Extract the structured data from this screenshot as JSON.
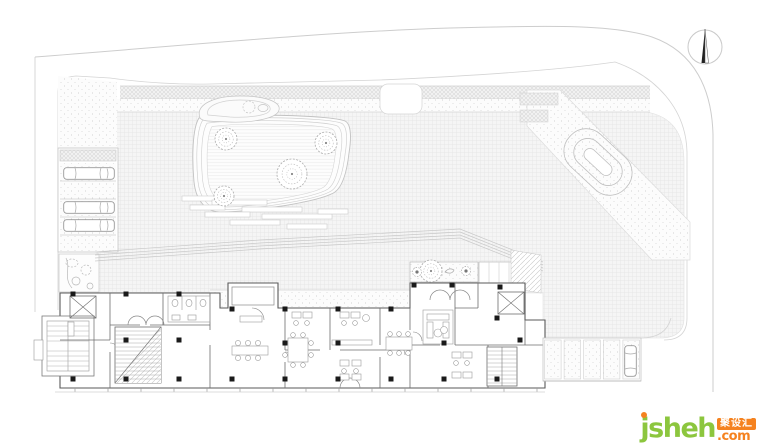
{
  "page": {
    "background": "#ffffff"
  },
  "logo": {
    "brand": "jsheh",
    "cjk": "聚设汇",
    "tld": ".com",
    "green": "#8cc63e",
    "orange": "#f5821f"
  },
  "plan": {
    "trees": [
      {
        "cx": 226,
        "cy": 139,
        "r": 11
      },
      {
        "cx": 326,
        "cy": 143,
        "r": 11
      },
      {
        "cx": 292,
        "cy": 174,
        "r": 15
      },
      {
        "cx": 224,
        "cy": 196,
        "r": 10
      },
      {
        "cx": 431,
        "cy": 271,
        "r": 11
      }
    ],
    "shrubs": [
      {
        "cx": 417,
        "cy": 272,
        "r": 4.5
      },
      {
        "cx": 466,
        "cy": 271,
        "r": 4.5
      }
    ],
    "left_parking": {
      "block": {
        "x": 58,
        "y": 148,
        "w": 60,
        "h": 104
      },
      "stall_lines_y": [
        181,
        199,
        217,
        235
      ],
      "cars": [
        {
          "x": 63,
          "y": 167
        },
        {
          "x": 63,
          "y": 201
        },
        {
          "x": 63,
          "y": 219
        }
      ]
    },
    "right_parking": {
      "x": 543,
      "y": 338,
      "w": 98,
      "h": 43,
      "stalls": 5,
      "car": {
        "x": 624,
        "y": 345
      }
    },
    "columns": [
      [
        73,
        294
      ],
      [
        126,
        294
      ],
      [
        179,
        294
      ],
      [
        232,
        309
      ],
      [
        285,
        309
      ],
      [
        338,
        309
      ],
      [
        391,
        309
      ],
      [
        414,
        285
      ],
      [
        452,
        285
      ],
      [
        500,
        287
      ],
      [
        73,
        379
      ],
      [
        126,
        379
      ],
      [
        179,
        379
      ],
      [
        232,
        379
      ],
      [
        285,
        379
      ],
      [
        338,
        379
      ],
      [
        391,
        379
      ],
      [
        444,
        379
      ],
      [
        497,
        379
      ],
      [
        126,
        340
      ],
      [
        179,
        340
      ],
      [
        285,
        343
      ],
      [
        338,
        343
      ],
      [
        444,
        343
      ],
      [
        497,
        318
      ],
      [
        520,
        340
      ]
    ]
  }
}
